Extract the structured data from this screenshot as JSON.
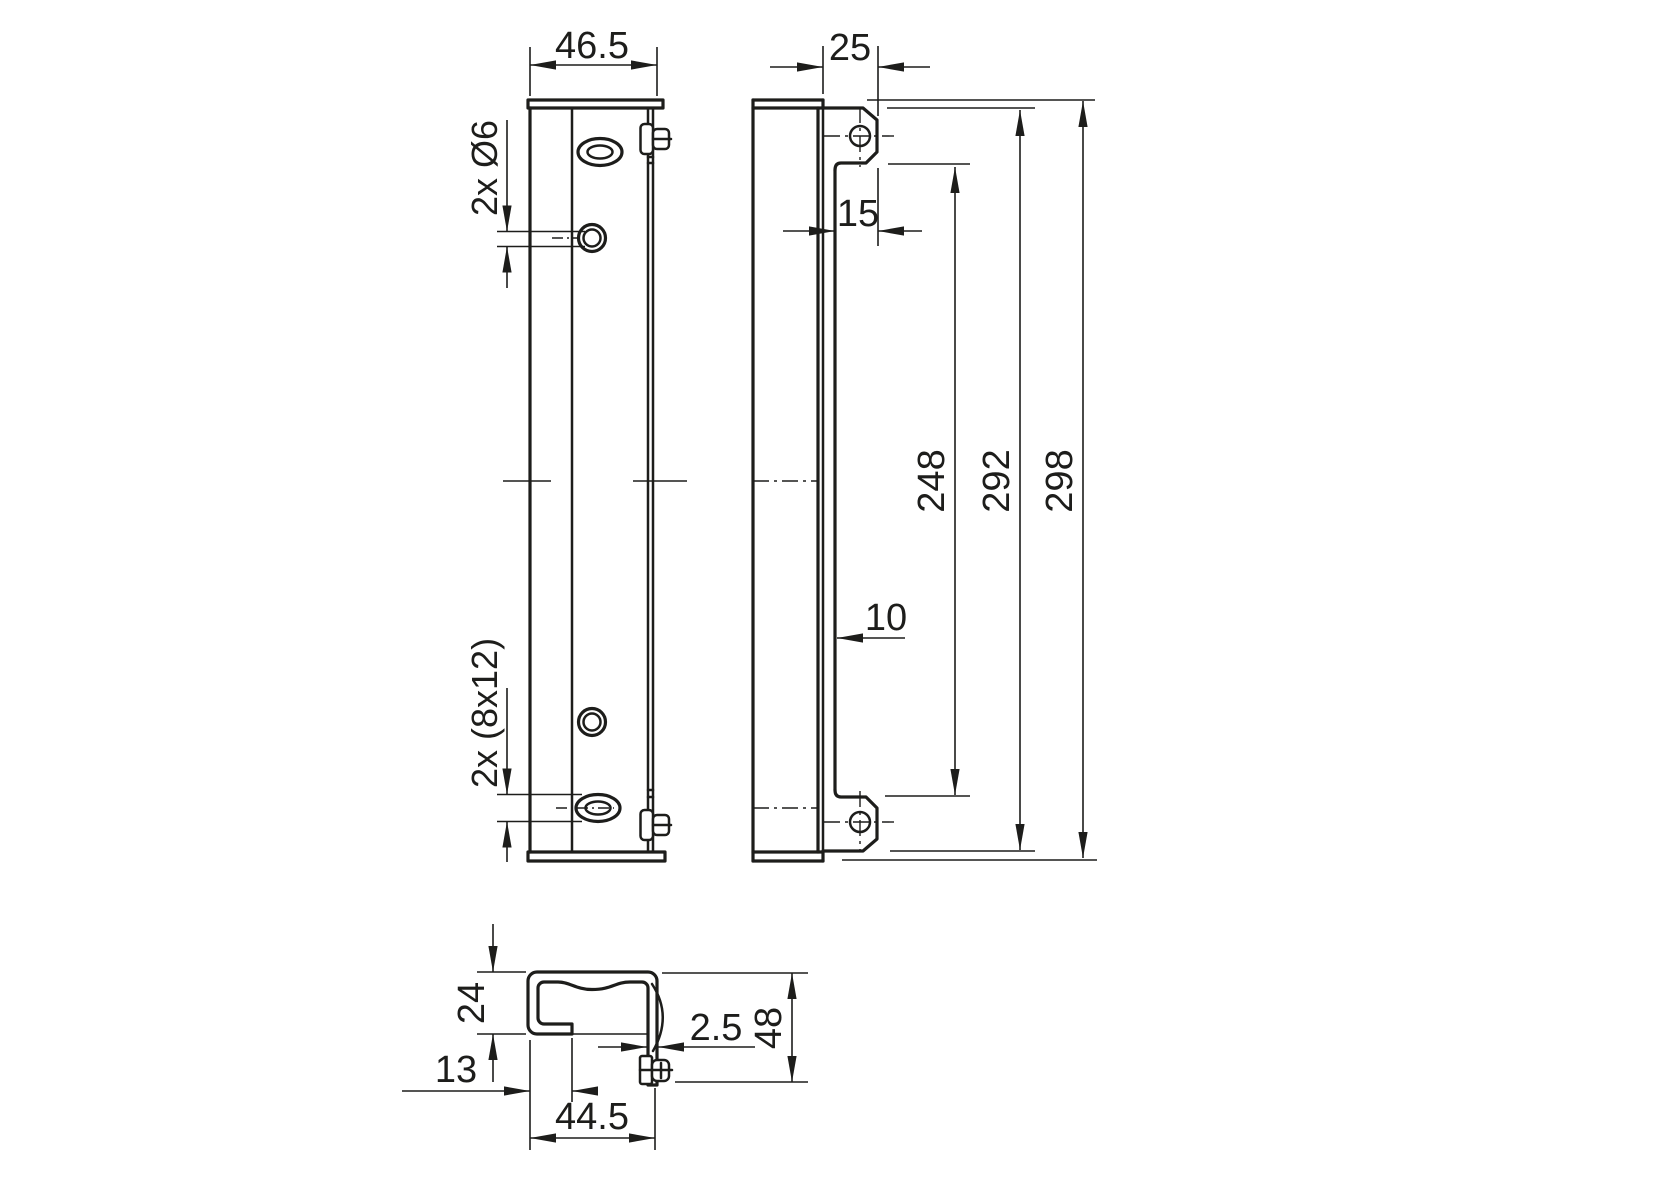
{
  "colors": {
    "background": "#ffffff",
    "line": "#1d1d1b"
  },
  "front_view": {
    "width_dim": "46.5",
    "top_holes_label": "2x Ø6",
    "bottom_slots_label": "2x (8x12)"
  },
  "side_view": {
    "depth_dim": "25",
    "tab_width_dim": "15",
    "web_offset_dim": "10",
    "inner_length_dim": "248",
    "hole_spacing_dim": "292",
    "overall_length_dim": "298"
  },
  "section_view": {
    "opening_height_dim": "24",
    "lip_width_dim": "13",
    "profile_width_dim": "44.5",
    "wall_thickness_dim": "2.5",
    "overall_height_dim": "48"
  }
}
